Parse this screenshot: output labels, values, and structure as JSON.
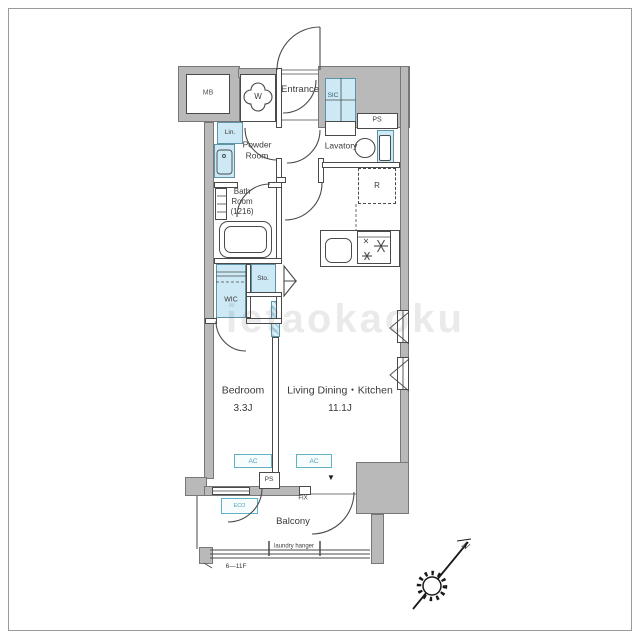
{
  "labels": {
    "mb": "MB",
    "washer": "W",
    "entrance": "Entrance",
    "sic": "SIC",
    "ps_top": "PS",
    "lin": "Lin.",
    "powder_1": "Powder",
    "powder_2": "Room",
    "lavatory": "Lavatory",
    "fridge": "R",
    "bath_1": "Bath",
    "bath_2": "Room",
    "bath_3": "(1216)",
    "sto": "Sto.",
    "wic": "WIC",
    "bedroom": "Bedroom",
    "bedroom_size": "3.3J",
    "ldk": "Living Dining・Kitchen",
    "ldk_size": "11.1J",
    "ac": "AC",
    "ps_bottom": "PS",
    "fix": "FIX",
    "direction_marker": "▼",
    "eco": "ECO",
    "balcony": "Balcony",
    "laundry_hanger": "laundry hanger",
    "floor_range": "6—11F",
    "north": "N"
  },
  "watermark": "ietaokaoku",
  "colors": {
    "fixture_blue": "#cde9f5",
    "accent_teal": "#62b2c6",
    "wall_gray": "#b9b9b9",
    "line": "#4a4a4a"
  }
}
